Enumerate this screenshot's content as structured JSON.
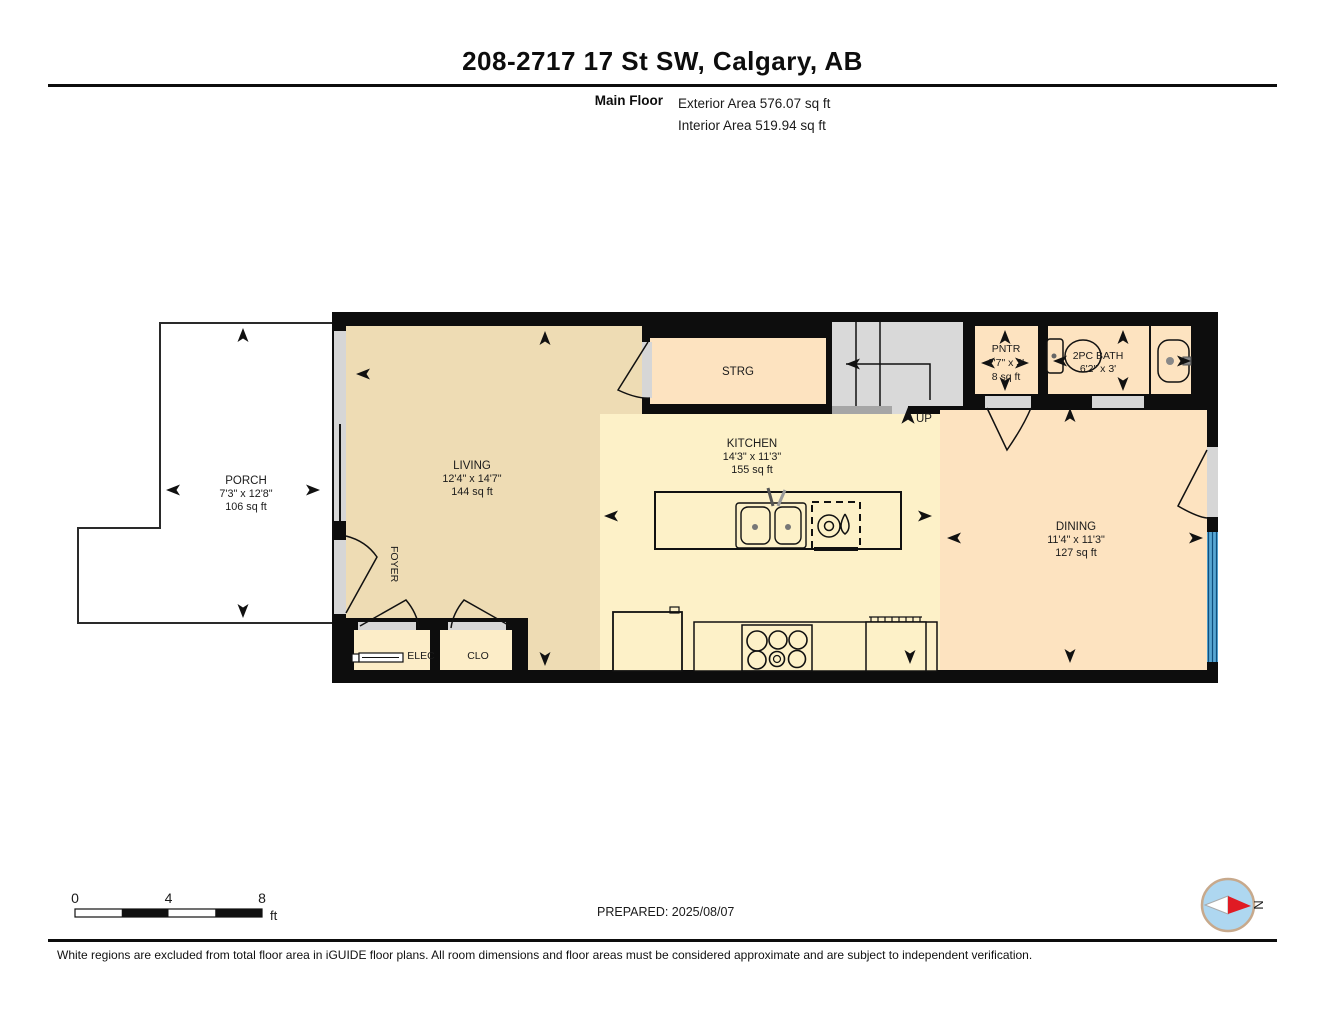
{
  "header": {
    "title": "208-2717 17 St SW, Calgary, AB",
    "floor_label": "Main Floor",
    "exterior_area": "Exterior Area 576.07 sq ft",
    "interior_area": "Interior Area 519.94 sq ft"
  },
  "rooms": {
    "porch": {
      "name": "PORCH",
      "dims": "7'3\" x 12'8\"",
      "area": "106 sq ft"
    },
    "living": {
      "name": "LIVING",
      "dims": "12'4\" x 14'7\"",
      "area": "144 sq ft"
    },
    "foyer": {
      "name": "FOYER"
    },
    "elec": {
      "name": "ELEC"
    },
    "clo": {
      "name": "CLO"
    },
    "strg": {
      "name": "STRG"
    },
    "stairs": {
      "label": "UP"
    },
    "kitchen": {
      "name": "KITCHEN",
      "dims": "14'3\" x 11'3\"",
      "area": "155 sq ft"
    },
    "dining": {
      "name": "DINING",
      "dims": "11'4\" x 11'3\"",
      "area": "127 sq ft"
    },
    "pntr": {
      "name": "PNTR",
      "dims": "2'7\" x 3'",
      "area": "8 sq ft"
    },
    "bath": {
      "name": "2PC BATH",
      "dims": "6'2\" x 3'"
    }
  },
  "scale_bar": {
    "tick_0": "0",
    "tick_4": "4",
    "tick_8": "8",
    "unit": "ft"
  },
  "compass": {
    "north_label": "N"
  },
  "footer": {
    "prepared": "PREPARED: 2025/08/07",
    "disclaimer": "White regions are excluded from total floor area in iGUIDE floor plans. All room dimensions and floor areas must be considered approximate and are subject to independent verification."
  },
  "colors": {
    "wall": "#0d0d0d",
    "living_floor": "#eedcb4",
    "kitchen_floor": "#fdf1c8",
    "dining_floor": "#fde3c0",
    "closet_floor": "#fcedc8",
    "stairs": "#d9d9d9",
    "opening": "#d6d6d6",
    "window_glass": "#58a7d4",
    "window_frame": "#0f4f7e",
    "compass_ring": "#c7a98c",
    "compass_face": "#aed7f0",
    "compass_needle": "#e01b24"
  }
}
